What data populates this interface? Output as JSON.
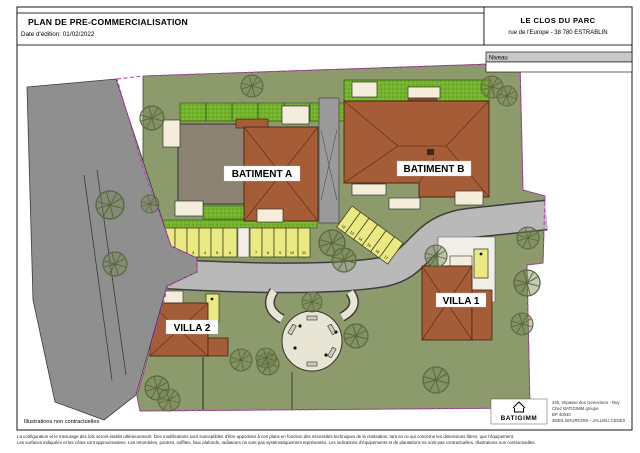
{
  "header": {
    "title": "PLAN DE PRE-COMMERCIALISATION",
    "edition_date": "Date d'édition: 01/02/2022",
    "project_name": "LE CLOS DU PARC",
    "project_address": "rue de l'Europe - 38 780 ESTRABLIN",
    "level_label": "Niveau",
    "level_value": ""
  },
  "plan": {
    "buildings": {
      "batiment_a": "BATIMENT A",
      "batiment_b": "BATIMENT B",
      "villa_1": "VILLA 1",
      "villa_2": "VILLA 2"
    },
    "parking": {
      "row1": [
        "1",
        "2",
        "3",
        "4",
        "5",
        "6"
      ],
      "row2": [
        "7",
        "8",
        "9",
        "10",
        "11"
      ],
      "diagonal": [
        "12",
        "13",
        "14",
        "15",
        "16",
        "17"
      ]
    },
    "colors": {
      "site_green": "#8c9a6c",
      "hedge_green": "#74b32b",
      "roof_brown": "#a55d38",
      "flat_roof_gray": "#8d8375",
      "road_gray": "#8f8f8f",
      "inner_road_gray": "#b9b9b9",
      "parking_yellow": "#ebe982",
      "terrace_cream": "#f3edda",
      "boundary_magenta": "#c23fc2",
      "circle_cream": "#e9e5d4"
    }
  },
  "footnotes": {
    "illustrations": "Illustrations non contractuelles",
    "line1": "La configuration et le mesurage des lots seront établis ultérieurement. Des modifications sont susceptibles d'être apportées à ces plans en fonction des nécessités techniques de la réalisation, tant en ce qui concerne les dimensions libres, que l'équipement.",
    "line2": "Les surfaces indiquées et les côtes sont approximatives. Les retombées, poutres, soffites, faux plafonds, radiateurs ne sont pas systématiquement représentés. Les indications d'équipements et de plantations ne sont pas contractuelles. Illustrations non contractuelles."
  },
  "publisher": {
    "logo_text": "BATIGIMM",
    "address_line1": "340, Impasse des Genevriers - Ruy",
    "address_line2": "Chez BATIGIMM groupe",
    "address_line3": "BP 40040",
    "address_line4": "38301 BOURGOIN - JALLIEU CEDEX"
  }
}
